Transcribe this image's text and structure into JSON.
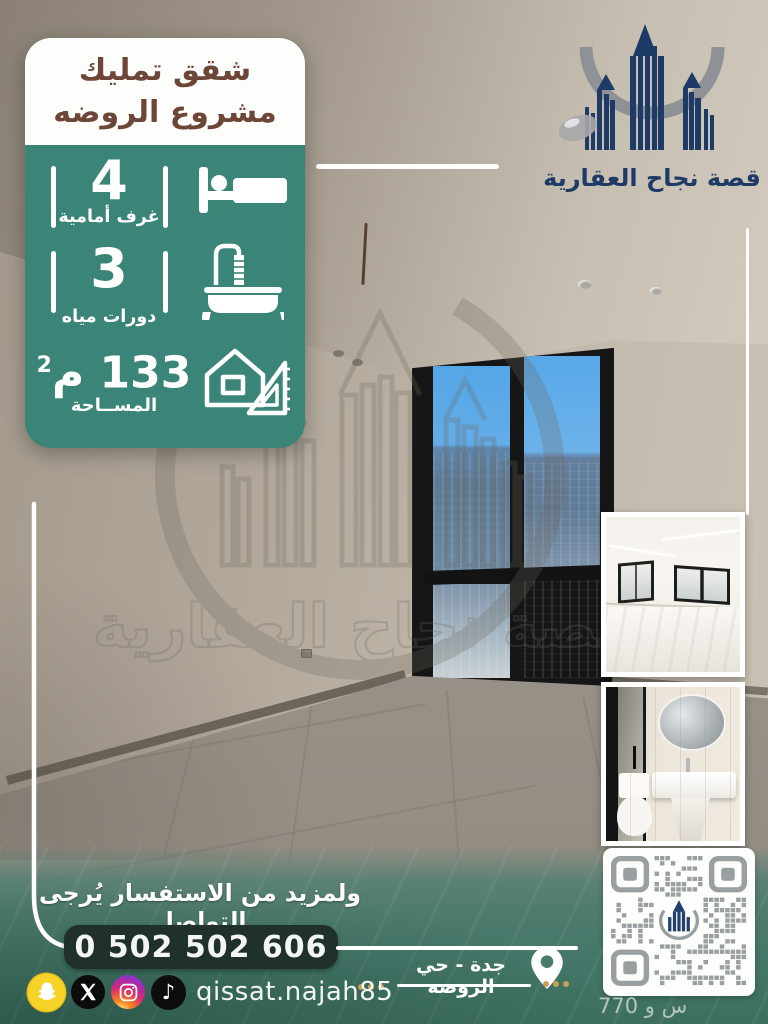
{
  "brand": {
    "name": "قصة نجاح العقارية"
  },
  "title_card": {
    "line1": "شقق تمليك",
    "line2": "مشروع الروضه"
  },
  "stats": {
    "rooms": {
      "value": "4",
      "label": "غرف أمامية"
    },
    "baths": {
      "value": "3",
      "label": "دورات مياه"
    },
    "area": {
      "value": "133",
      "unit": "م",
      "sup": "2",
      "label": "المســاحة"
    }
  },
  "contact": {
    "prompt": "ولمزيد من الاستفسار يُرجى التواصل",
    "phone": "0 502 502 606",
    "username": "qissat.najah85",
    "social": [
      "snapchat",
      "x",
      "instagram",
      "tiktok"
    ]
  },
  "location": {
    "text": "جدة - حي الروضه"
  },
  "watermark_caption": "770 س و",
  "colors": {
    "card_teal": "#3A8577",
    "banner_teal": "#45786A",
    "navy": "#1E3A66",
    "arc_gray": "#8E9196",
    "title_brown": "#6D4637",
    "gold": "#C9A053",
    "pill_dark": "#20302A"
  }
}
